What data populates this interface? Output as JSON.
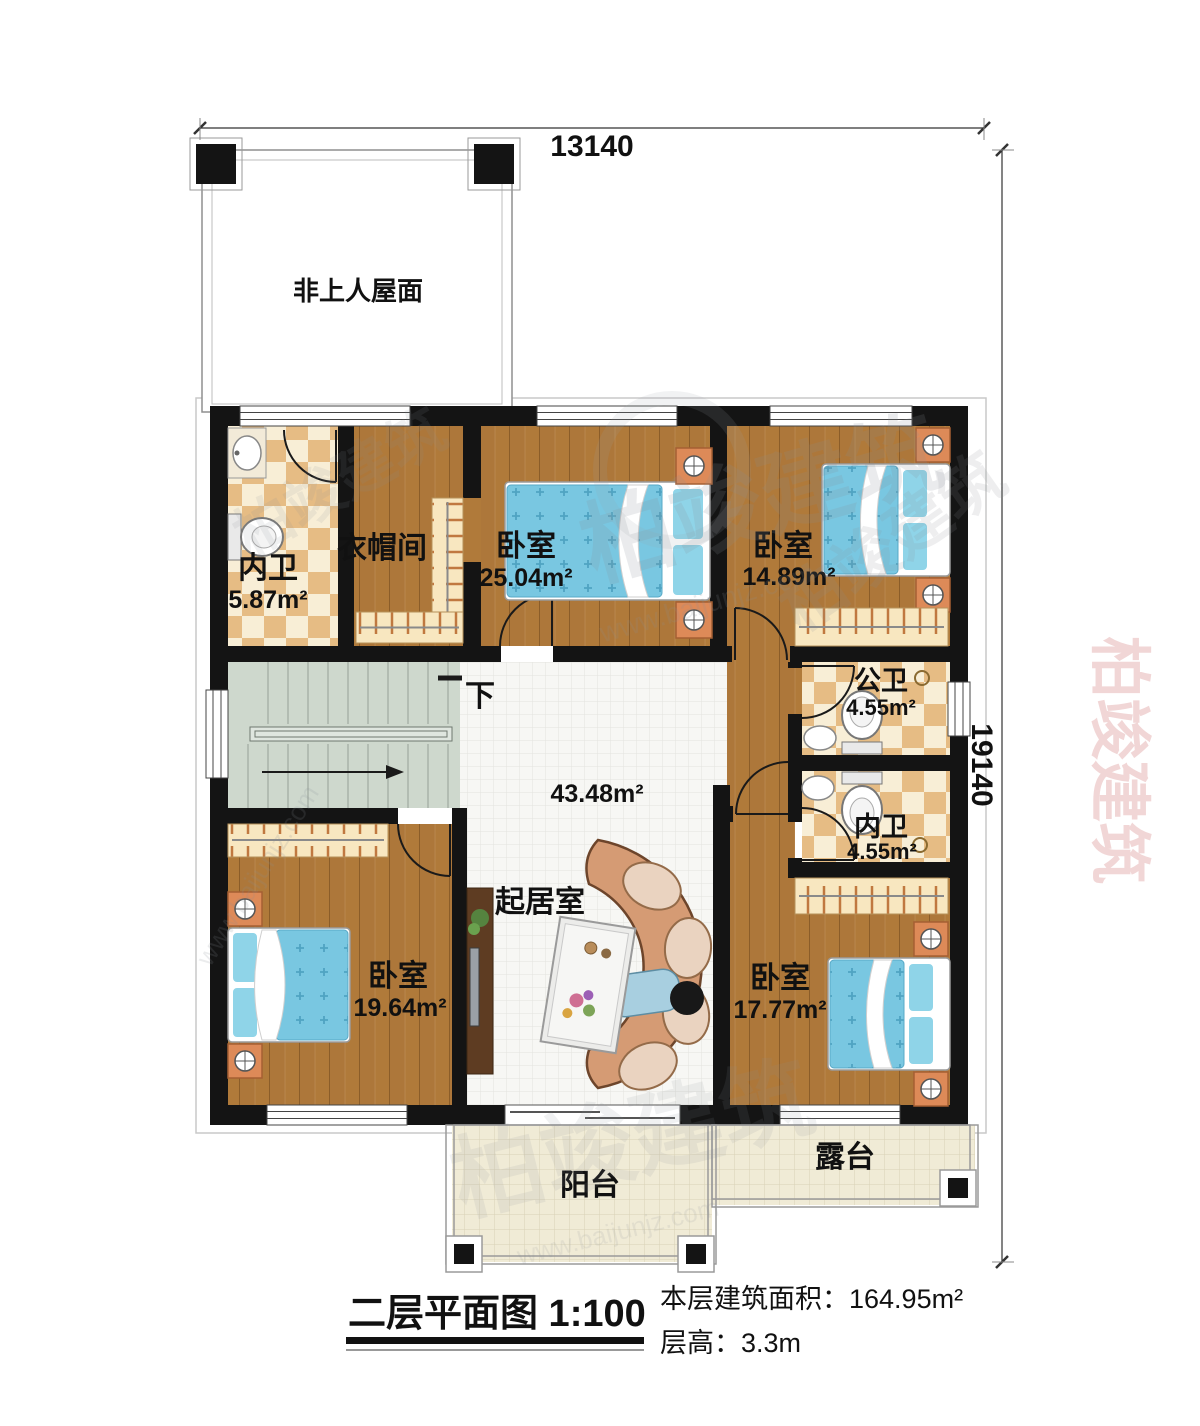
{
  "plan": {
    "title": "二层平面图 1:100",
    "floor_area_label": "本层建筑面积：164.95m²",
    "floor_height_label": "层高：3.3m",
    "dim_width": "13140",
    "dim_height": "19140",
    "roof_label": "非上人屋面",
    "stairs_down_label": "下",
    "scale": "1:100"
  },
  "rooms": [
    {
      "name": "内卫",
      "area": "5.87m²"
    },
    {
      "name": "衣帽间",
      "area": ""
    },
    {
      "name": "卧室",
      "area": "25.04m²"
    },
    {
      "name": "卧室",
      "area": "14.89m²"
    },
    {
      "name": "公卫",
      "area": "4.55m²"
    },
    {
      "name": "内卫",
      "area": "4.55m²"
    },
    {
      "name": "起居室",
      "area": "43.48m²"
    },
    {
      "name": "卧室",
      "area": "19.64m²"
    },
    {
      "name": "卧室",
      "area": "17.77m²"
    },
    {
      "name": "阳台",
      "area": ""
    },
    {
      "name": "露台",
      "area": ""
    }
  ],
  "watermark": {
    "brand": "柏竣建筑",
    "url": "www.baijunjz.com"
  },
  "palette": {
    "wall": "#141414",
    "wood_floor": "#b07a3a",
    "tile_floor": "#f7f7f4",
    "bath_tile": "#e6bc84",
    "outdoor_tile": "#f0ebd6",
    "stairs": "#ced8cd",
    "bed": "#79c7e1",
    "accent_furniture": "#dd8a58"
  }
}
